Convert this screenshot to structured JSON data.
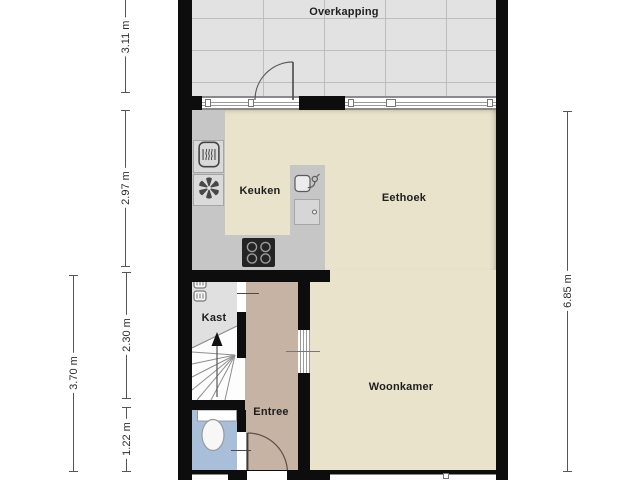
{
  "rooms": {
    "overkapping": {
      "label": "Overkapping"
    },
    "keuken": {
      "label": "Keuken"
    },
    "eethoek": {
      "label": "Eethoek"
    },
    "kast": {
      "label": "Kast"
    },
    "entree": {
      "label": "Entree"
    },
    "woonkamer": {
      "label": "Woonkamer"
    }
  },
  "dimensions": {
    "overkapping_depth": {
      "label": "3.11 m"
    },
    "kitchen_depth": {
      "label": "2.97 m"
    },
    "stairs_depth": {
      "label": "2.30 m"
    },
    "toilet_depth": {
      "label": "1.22 m"
    },
    "hall_depth_total": {
      "label": "3.70 m"
    },
    "living_depth_total": {
      "label": "6.85 m"
    }
  },
  "icons": {
    "kitchen": [
      "oven-icon",
      "extractor-fan-icon",
      "cooktop-icon",
      "sink-icon",
      "dishwasher-icon"
    ],
    "kast": [
      "meter-icon"
    ],
    "toilet": [
      "toilet-icon",
      "hand-basin-icon"
    ],
    "stairs": [
      "stairs-up-arrow-icon"
    ]
  },
  "colors": {
    "wall": "#0d0d0d",
    "living_floor": "#e9e3cc",
    "hall_floor": "#c6b3a3",
    "closet_floor": "#e0e0e0",
    "toilet_floor": "#a8bed9",
    "canopy_floor": "#e2e2e2",
    "counter": "#c6c6c6"
  }
}
